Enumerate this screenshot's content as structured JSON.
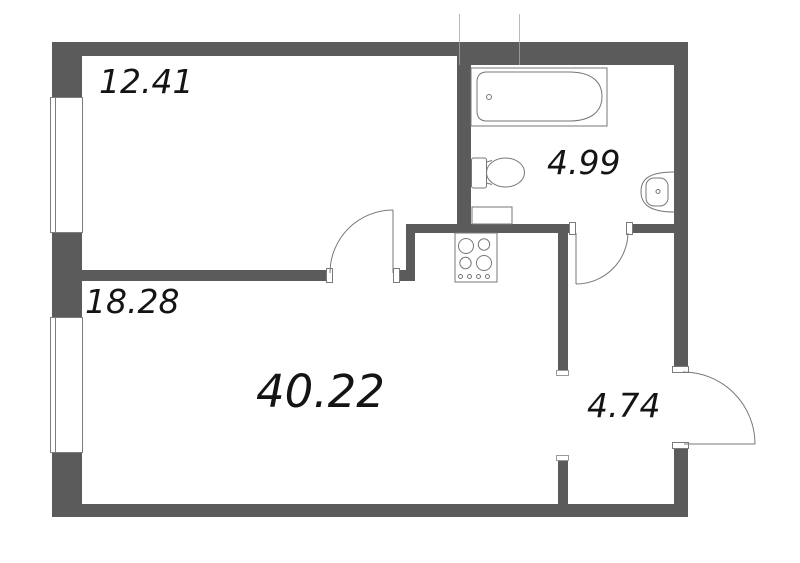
{
  "areas": {
    "top_left_room": "12.41",
    "left_room": "18.28",
    "main_room": "40.22",
    "bathroom": "4.99",
    "hallway": "4.74"
  },
  "fixture_icons": [
    "bathtub-icon",
    "toilet-icon",
    "washing-machine-icon",
    "sink-icon",
    "stove-icon",
    "window-icon",
    "door-swing-icon"
  ],
  "colors": {
    "wall": "#5b5b5b",
    "fixture_line": "#777777",
    "label_text": "#141414",
    "background": "#ffffff"
  }
}
